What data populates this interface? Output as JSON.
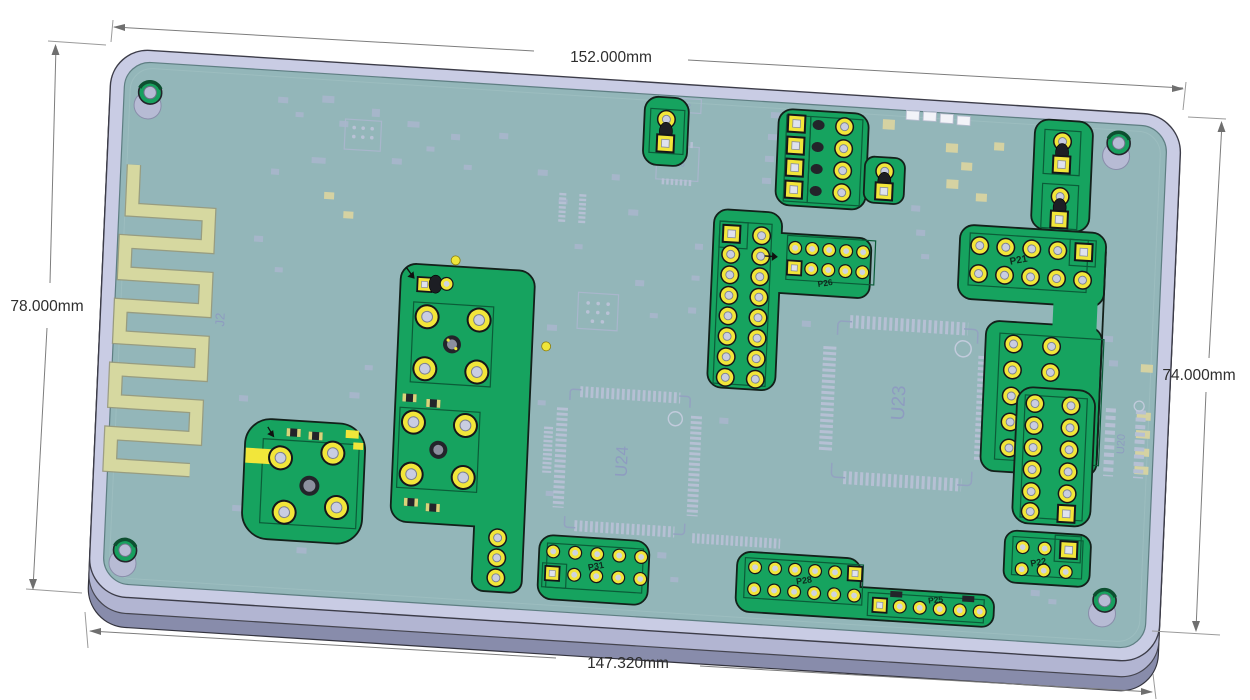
{
  "dimensions": {
    "top": "152.000mm",
    "bottom": "147.320mm",
    "left": "78.000mm",
    "right": "74.000mm"
  },
  "refs": {
    "antenna": "J2",
    "fuse": "F32",
    "u23": "U23",
    "u24": "U24",
    "u26": "U26",
    "u20": "U20",
    "p21": "P21",
    "p22": "P22",
    "p25": "P25",
    "p26": "P26",
    "p28": "P28",
    "p31": "P31"
  },
  "colors": {
    "plate": "#c9cce4",
    "plate_side": "#b2b5d2",
    "plate_side_dark": "#888cab",
    "pcb_coating": "#93b6b9",
    "island_green": "#16a35f",
    "pad_yellow": "#f2e63a",
    "antenna_trace": "#d6d8a0",
    "silkscreen": "#a9b6cc",
    "dimension_text": "#2e2e2e"
  }
}
